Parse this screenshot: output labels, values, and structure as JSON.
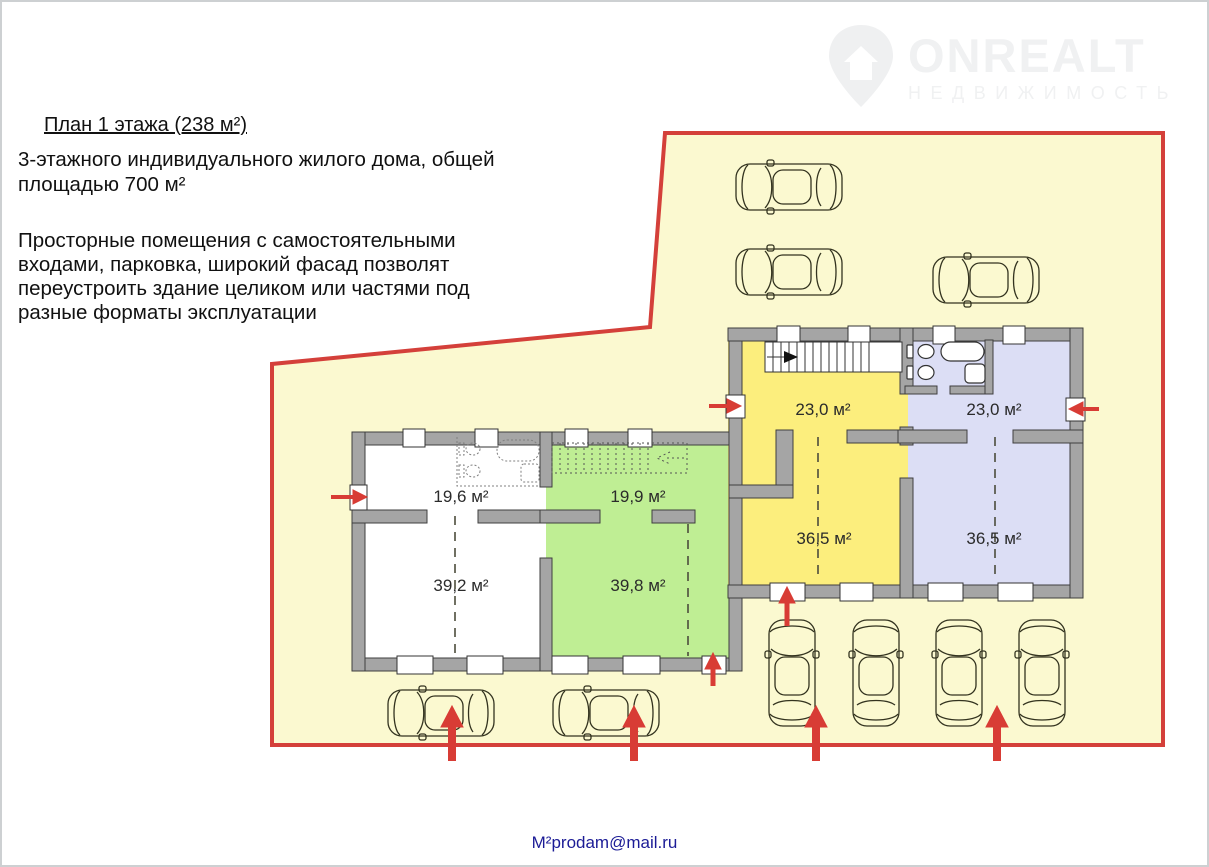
{
  "header": {
    "title": "План 1 этажа (238 м²)",
    "subtitle": "3-этажного индивидуального жилого дома, общей\nплощадью 700 м²",
    "description": "Просторные помещения с самостоятельными\nвходами, парковка, широкий фасад позволят\nпереустроить здание целиком или частями под\nразные форматы эксплуатации"
  },
  "watermark": {
    "brand": "ONREALT",
    "tagline": "НЕДВИЖИМОСТЬ"
  },
  "footer": {
    "email": "М²prodam@mail.ru"
  },
  "plan": {
    "rooms": [
      {
        "name": "room-19-6",
        "label": "19,6 м²",
        "section": "white"
      },
      {
        "name": "room-19-9",
        "label": "19,9 м²",
        "section": "green"
      },
      {
        "name": "room-39-2",
        "label": "39,2 м²",
        "section": "white"
      },
      {
        "name": "room-39-8",
        "label": "39,8 м²",
        "section": "green"
      },
      {
        "name": "room-23-0-left",
        "label": "23,0 м²",
        "section": "yellow"
      },
      {
        "name": "room-23-0-right",
        "label": "23,0 м²",
        "section": "lavender"
      },
      {
        "name": "room-36-5-left",
        "label": "36,5 м²",
        "section": "yellow"
      },
      {
        "name": "room-36-5-right",
        "label": "36,5 м²",
        "section": "lavender"
      }
    ],
    "colors": {
      "lot_fill": "#fbf9d0",
      "lot_border": "#d4403a",
      "wall": "#a5a5a5",
      "floor_white": "#ffffff",
      "floor_green": "#bfee94",
      "floor_yellow": "#fcee7d",
      "floor_lavender": "#dcdef5",
      "arrow": "#d83c35",
      "email_text": "#1b1b96"
    }
  }
}
